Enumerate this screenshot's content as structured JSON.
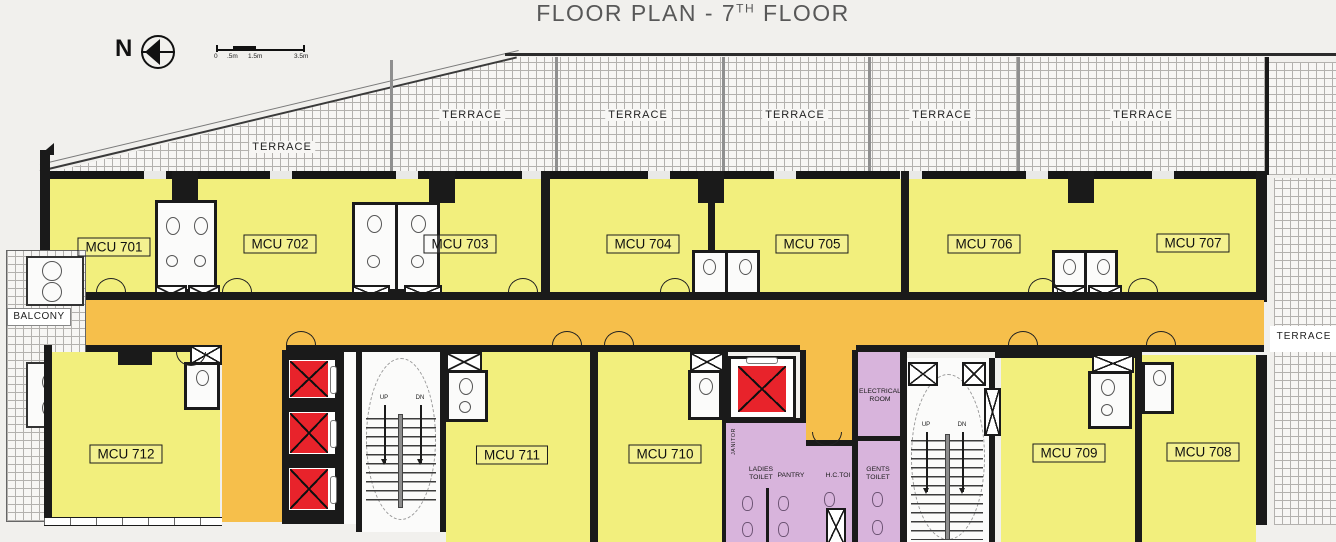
{
  "title": {
    "prefix": "FLOOR PLAN - 7",
    "superscript": "TH",
    "suffix": "FLOOR"
  },
  "compass": {
    "north_label": "N"
  },
  "scale_bar": {
    "labels": [
      "0",
      ".5m",
      "1.5m",
      "3.5m"
    ]
  },
  "terrace": {
    "top_labels": [
      "TERRACE",
      "TERRACE",
      "TERRACE",
      "TERRACE",
      "TERRACE",
      "TERRACE"
    ],
    "right_label": "TERRACE"
  },
  "balcony": {
    "label": "BALCONY"
  },
  "units": [
    {
      "id": "701",
      "label": "MCU 701"
    },
    {
      "id": "702",
      "label": "MCU 702"
    },
    {
      "id": "703",
      "label": "MCU 703"
    },
    {
      "id": "704",
      "label": "MCU 704"
    },
    {
      "id": "705",
      "label": "MCU 705"
    },
    {
      "id": "706",
      "label": "MCU 706"
    },
    {
      "id": "707",
      "label": "MCU 707"
    },
    {
      "id": "708",
      "label": "MCU 708"
    },
    {
      "id": "709",
      "label": "MCU 709"
    },
    {
      "id": "710",
      "label": "MCU 710"
    },
    {
      "id": "711",
      "label": "MCU 711"
    },
    {
      "id": "712",
      "label": "MCU 712"
    }
  ],
  "stairs": {
    "up_label": "UP",
    "down_label": "DN"
  },
  "service_rooms": {
    "electrical_line1": "ELECTRICAL",
    "electrical_line2": "ROOM",
    "ladies_line1": "LADIES",
    "ladies_line2": "TOILET",
    "pantry": "PANTRY",
    "hc_toilet": "H.C.TOI",
    "gents_line1": "GENTS",
    "gents_line2": "TOILET",
    "janitor": "JANITOR"
  },
  "colors": {
    "wall": "#1a1a1a",
    "room_yellow": "#f2ef7d",
    "corridor_orange": "#f6bf4b",
    "service_purple": "#d8b4dc",
    "elevator_red": "#e8232b",
    "background": "#f1f0ed"
  }
}
